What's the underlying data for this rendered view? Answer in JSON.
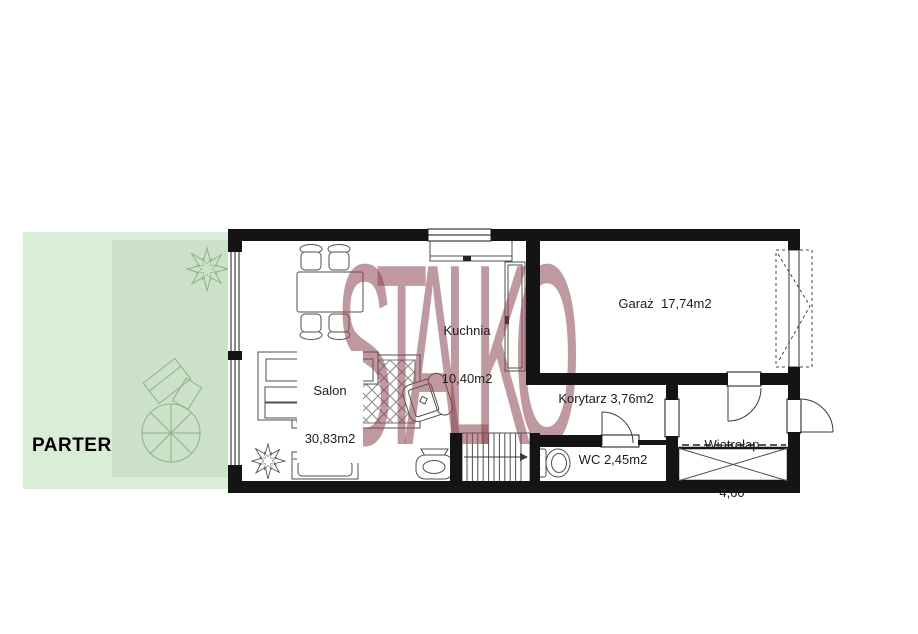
{
  "floor_label": "PARTER",
  "watermark_text": "STALKO",
  "rooms": {
    "kuchnia": {
      "name": "Kuchnia",
      "area": "10,40m2"
    },
    "salon": {
      "name": "Salon",
      "area": "30,83m2"
    },
    "garaz": {
      "label": "Garaż  17,74m2"
    },
    "korytarz": {
      "label": "Korytarz 3,76m2"
    },
    "wc": {
      "label": "WC 2,45m2"
    },
    "wiatrolap": {
      "name": "Wiatrołap",
      "area": "4,60"
    }
  },
  "colors": {
    "wall": "#141414",
    "garden_light": "#d9eed7",
    "garden_dark": "#cbe2c8",
    "garden_stroke": "#93ae90",
    "furniture_stroke": "#4f4f4f",
    "fine_stroke": "#3a3a3a",
    "watermark": "#8b4550",
    "label_text": "#1d1d1d"
  }
}
